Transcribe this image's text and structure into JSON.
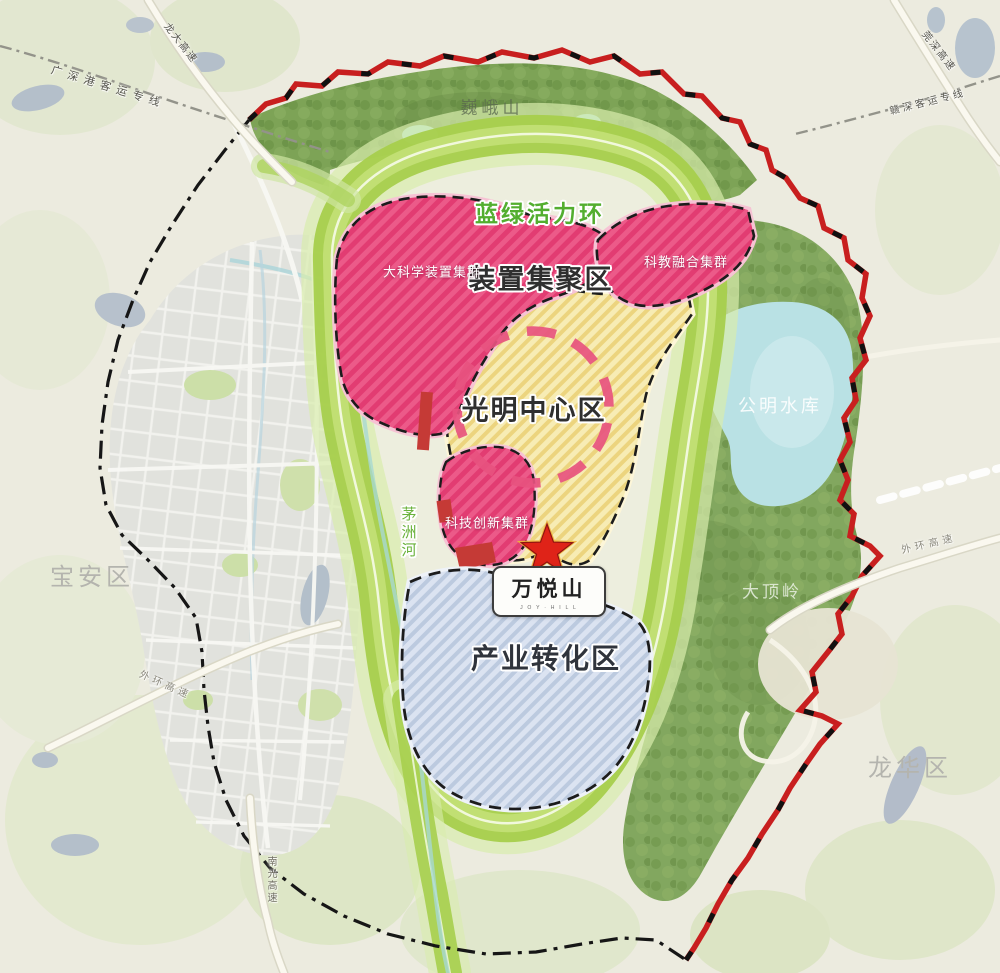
{
  "map_labels": {
    "ring": "蓝绿活力环",
    "device_zone": "装置集聚区",
    "big_science_cluster": "大科学装置集群",
    "sci_edu_cluster": "科教融合集群",
    "center_zone": "光明中心区",
    "tech_cluster": "科技创新集群",
    "industry_zone": "产业转化区",
    "wanyue_title": "万悦山",
    "wanyue_sub": "J O Y · H I L L",
    "reservoir": "公明水库",
    "ridge": "大顶岭",
    "mountain": "巍峨山",
    "river": "茅洲河",
    "baoan": "宝安区",
    "longhua": "龙华区"
  },
  "road_labels": {
    "gsg_rail": "广深港客运专线",
    "ganshen_rail": "赣深客运专线",
    "longda": "龙大高速",
    "wanshen": "莞深高速",
    "outer_ring_right": "外环高速",
    "outer_ring_left": "外环高速",
    "nanguang": "南光高速"
  },
  "colors": {
    "pink_zone": "#ec5a89",
    "yellow_zone": "#f7ecb4",
    "blue_zone": "#dbe3f1",
    "ring_green": "#a6cf4c",
    "forest_green": "#82a75f",
    "reservoir_blue": "#b9e1e4",
    "boundary_red": "#c81f1f",
    "circle_pink": "#e7537f",
    "star_red": "#df2318"
  }
}
